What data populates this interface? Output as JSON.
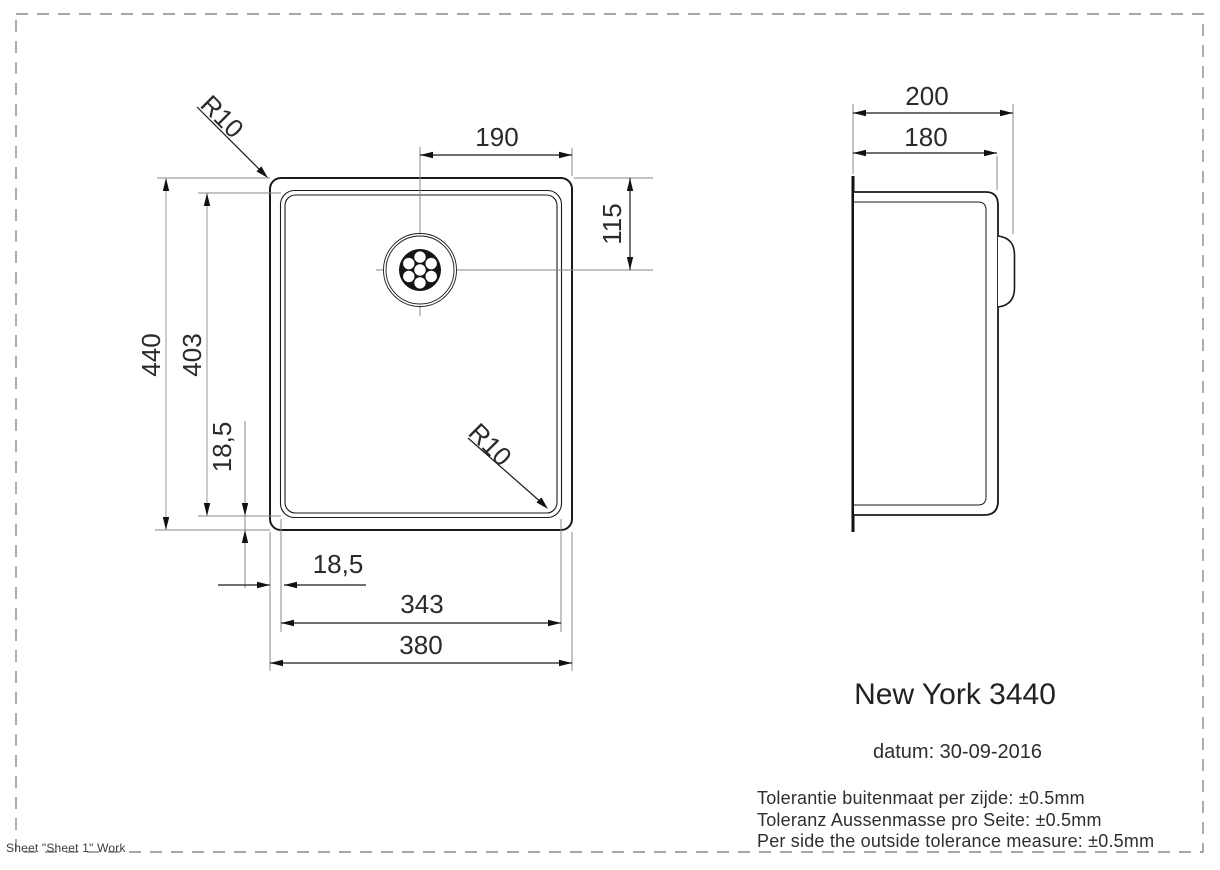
{
  "drawing": {
    "front_view": {
      "labels": {
        "width_outer": "380",
        "width_inner": "343",
        "height_outer": "440",
        "height_inner": "403",
        "rim_inset_vertical": "18,5",
        "rim_inset_horizontal": "18,5",
        "drain_from_right": "190",
        "drain_from_top": "115",
        "corner_radius_top": "R10",
        "corner_radius_bottom": "R10"
      }
    },
    "side_view": {
      "labels": {
        "depth_outer": "200",
        "depth_inner": "180"
      }
    }
  },
  "title_block": {
    "product_name": "New York 3440",
    "date_line": "datum: 30-09-2016",
    "tolerance_lines": [
      "Tolerantie buitenmaat per zijde: ±0.5mm",
      "Toleranz Aussenmasse pro Seite: ±0.5mm",
      "Per side the outside tolerance measure: ±0.5mm"
    ]
  },
  "footer": {
    "sheet_label": "Sheet \"Sheet 1\" Work"
  }
}
